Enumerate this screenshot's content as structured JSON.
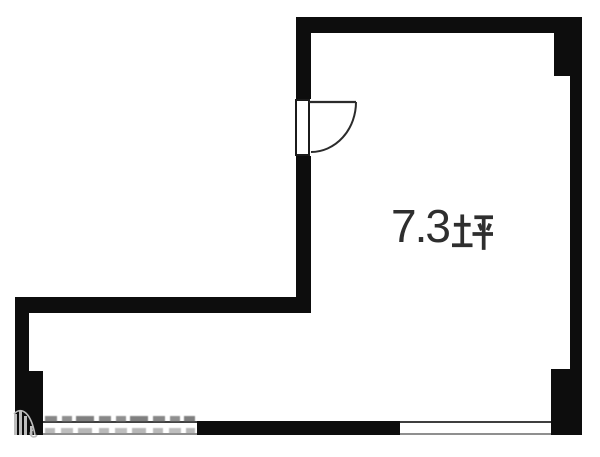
{
  "floorplan": {
    "area_label": "7.3坪",
    "area_value": "7.3",
    "area_unit": "坪",
    "features": {
      "door": "hinged-door-upper-left-wall",
      "windows": [
        "bottom-wall-left",
        "bottom-wall-right"
      ],
      "watermark": {
        "present": true,
        "legible": false
      }
    },
    "colors": {
      "wall": "#0d0d0d",
      "door_line": "#2b2b2b",
      "window_line_dark": "#3f3f3f",
      "window_line_light": "#8f8f8f",
      "text": "#2e2e2e",
      "watermark": "#bdbdbd",
      "background": "#ffffff"
    }
  }
}
